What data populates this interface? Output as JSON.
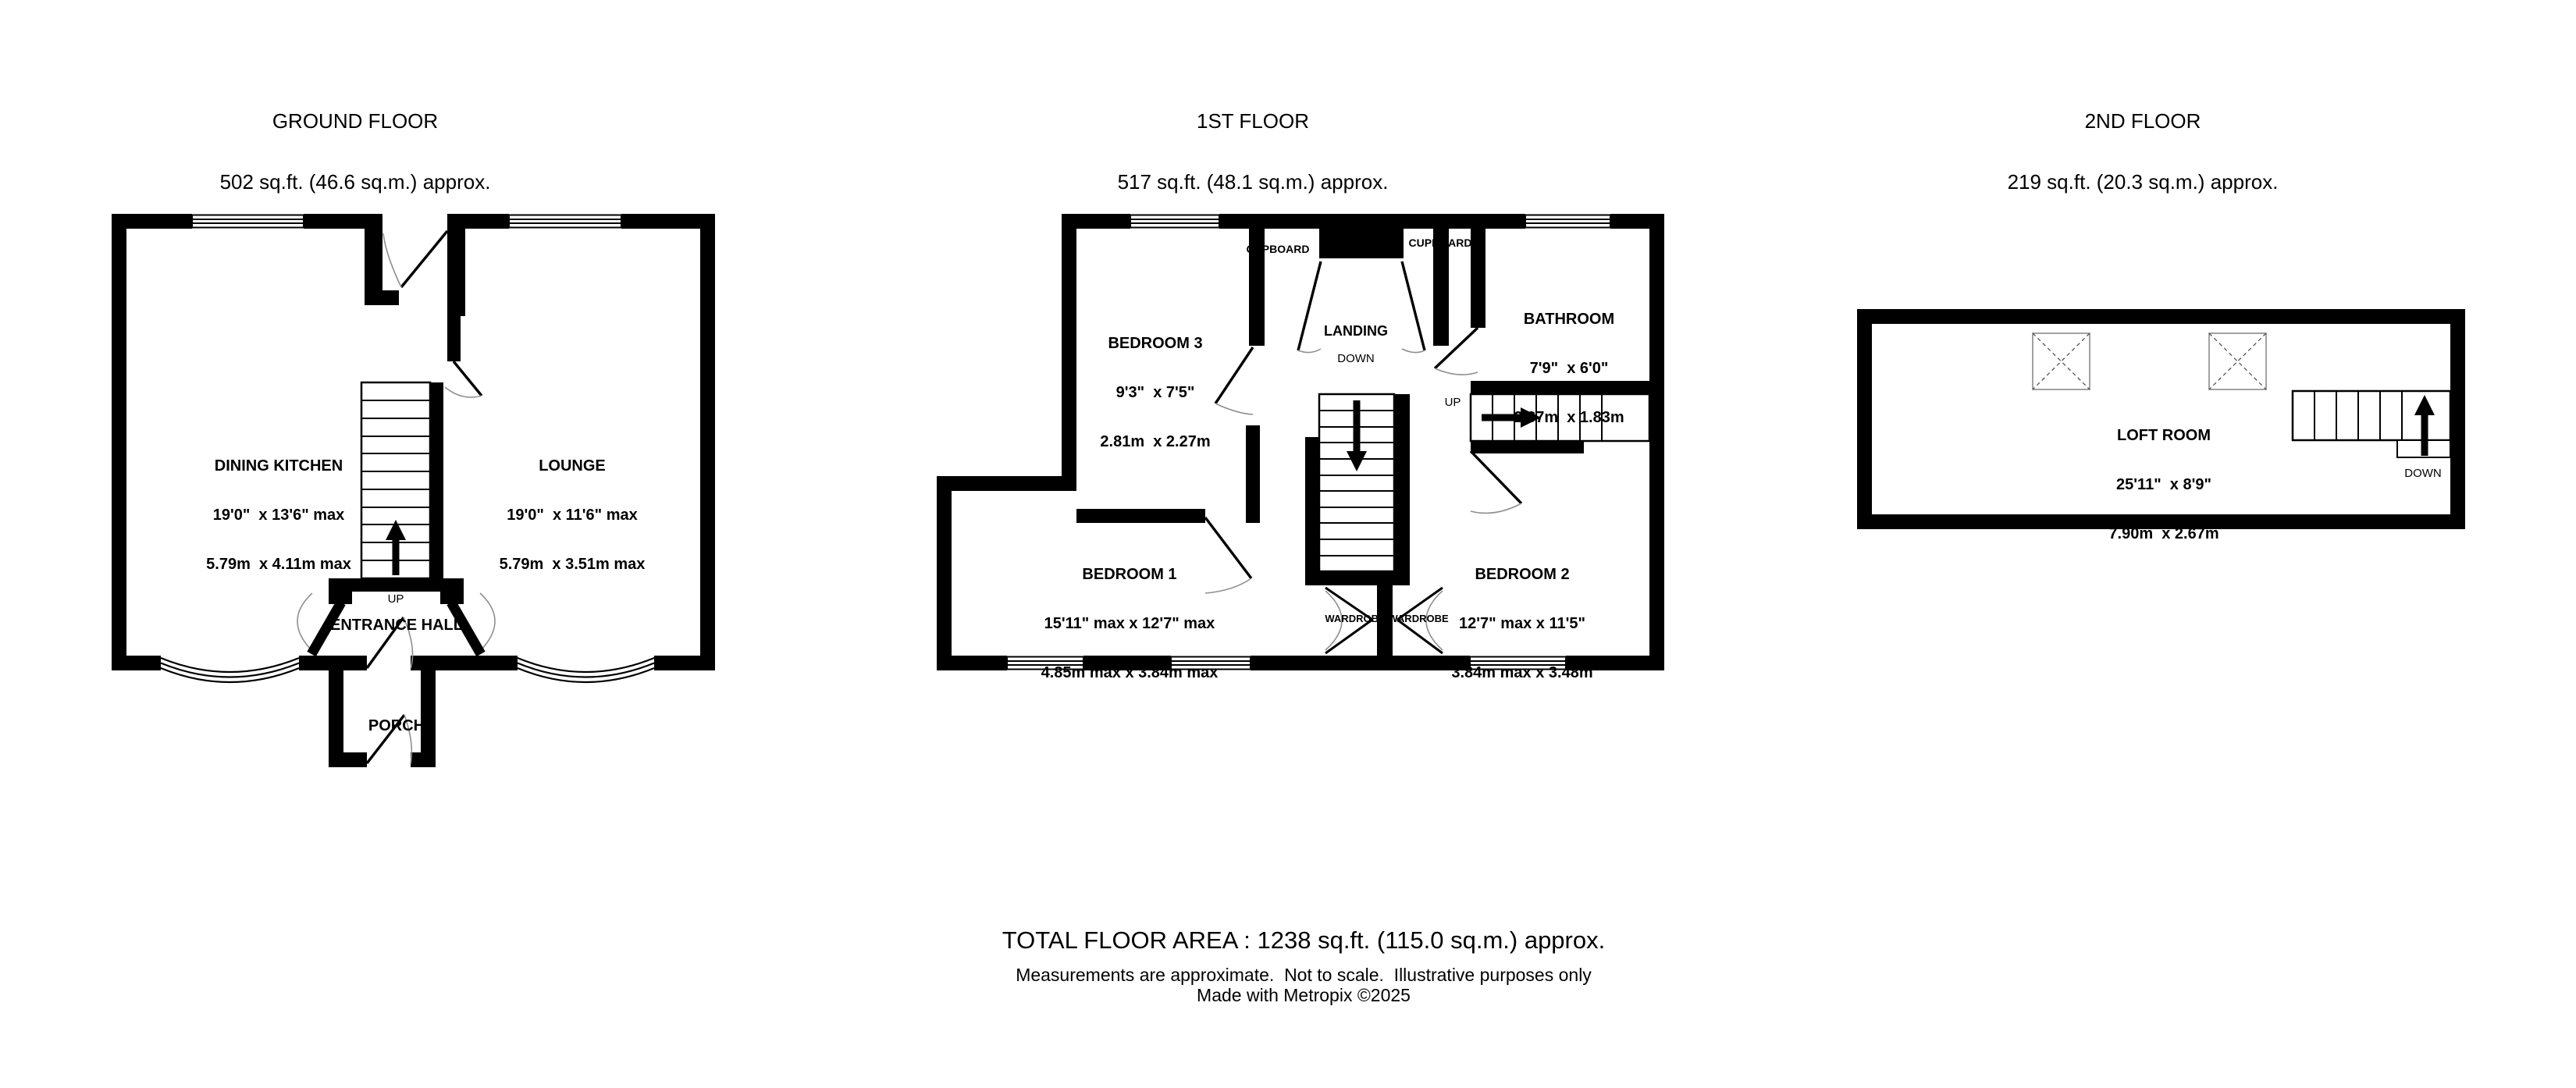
{
  "floors": [
    {
      "title": "GROUND FLOOR",
      "area": "502 sq.ft. (46.6 sq.m.) approx.",
      "rooms": [
        {
          "name": "DINING KITCHEN",
          "imperial": "19'0\"  x 13'6\" max",
          "metric": "5.79m  x 4.11m max"
        },
        {
          "name": "LOUNGE",
          "imperial": "19'0\"  x 11'6\" max",
          "metric": "5.79m  x 3.51m max"
        },
        {
          "name": "ENTRANCE HALL"
        },
        {
          "name": "PORCH"
        }
      ],
      "labels": {
        "up": "UP"
      }
    },
    {
      "title": "1ST FLOOR",
      "area": "517 sq.ft. (48.1 sq.m.) approx.",
      "rooms": [
        {
          "name": "BEDROOM 3",
          "imperial": "9'3\"  x 7'5\"",
          "metric": "2.81m  x 2.27m"
        },
        {
          "name": "BATHROOM",
          "imperial": "7'9\"  x 6'0\"",
          "metric": "2.37m  x 1.83m"
        },
        {
          "name": "BEDROOM 1",
          "imperial": "15'11\" max x 12'7\" max",
          "metric": "4.85m max x 3.84m max"
        },
        {
          "name": "BEDROOM 2",
          "imperial": "12'7\" max x 11'5\"",
          "metric": "3.84m max x 3.48m"
        },
        {
          "name": "LANDING"
        }
      ],
      "labels": {
        "down": "DOWN",
        "up": "UP",
        "cupboard_left": "CUPBOARD",
        "cupboard_right": "CUPBOARD",
        "wardrobe_left": "WARDROBE",
        "wardrobe_right": "WARDROBE"
      }
    },
    {
      "title": "2ND FLOOR",
      "area": "219 sq.ft. (20.3 sq.m.) approx.",
      "rooms": [
        {
          "name": "LOFT ROOM",
          "imperial": "25'11\"  x 8'9\"",
          "metric": "7.90m  x 2.67m"
        }
      ],
      "labels": {
        "down": "DOWN"
      }
    }
  ],
  "footer": {
    "total": "TOTAL FLOOR AREA : 1238 sq.ft. (115.0 sq.m.) approx.",
    "disclaimer": "Measurements are approximate.  Not to scale.  Illustrative purposes only",
    "credit": "Made with Metropix ©2025"
  }
}
